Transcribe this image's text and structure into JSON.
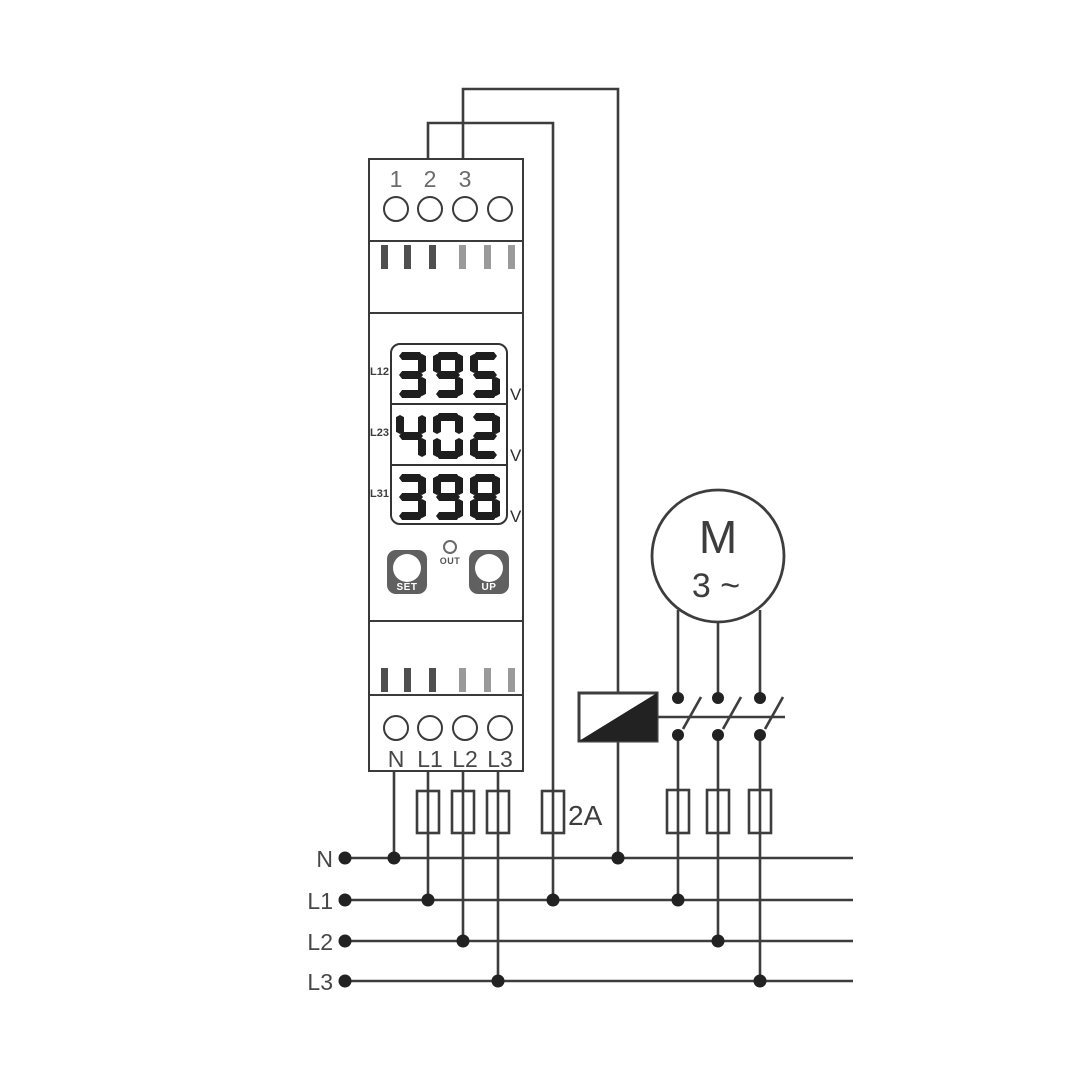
{
  "device": {
    "top_terminals": [
      "1",
      "2",
      "3"
    ],
    "bottom_terminals": [
      "N",
      "L1",
      "L2",
      "L3"
    ],
    "display_rows": [
      {
        "label": "L12",
        "value": "395",
        "unit": "V"
      },
      {
        "label": "L23",
        "value": "402",
        "unit": "V"
      },
      {
        "label": "L31",
        "value": "398",
        "unit": "V"
      }
    ],
    "set_button": "SET",
    "up_button": "UP",
    "out_led": "OUT"
  },
  "circuit": {
    "fuse_rating": "2A",
    "motor_letter": "M",
    "motor_phase": "3 ~",
    "bus_labels": [
      "N",
      "L1",
      "L2",
      "L3"
    ]
  },
  "colors": {
    "line": "#3d3d3d",
    "digit_segment": "#1e1e1e",
    "button_bg": "#606060",
    "vent_dark": "#4f4f4f",
    "vent_light": "#9a9a9a",
    "contact_dot": "#222222"
  }
}
